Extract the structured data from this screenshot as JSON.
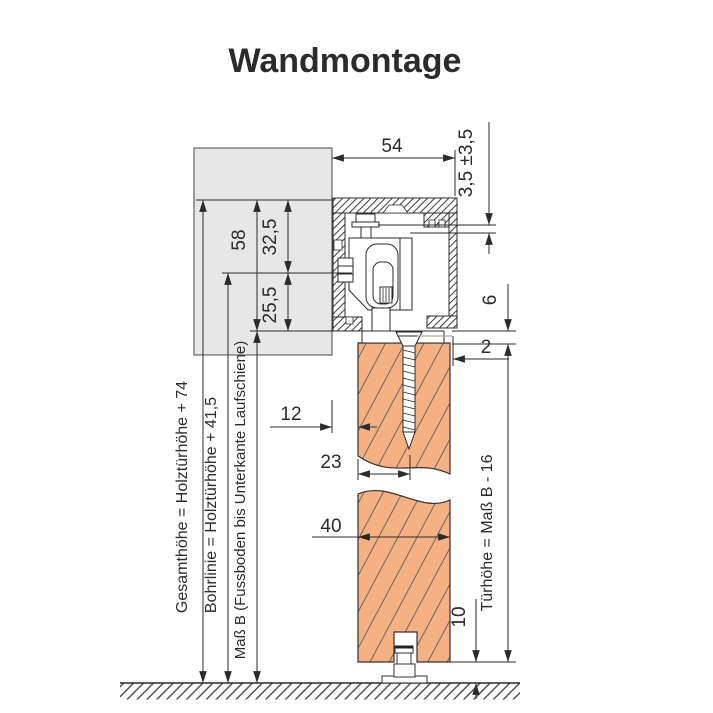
{
  "title": "Wandmontage",
  "colors": {
    "title": "#404040",
    "line": "#2b2b2b",
    "wall_fill": "#e8e7e7",
    "door_fill": "#f6b183",
    "door_hatch": "#666666",
    "aux_gray": "#a6a6a6"
  },
  "dimensions": {
    "track_width": "54",
    "height_adjust": "3,5 ±3,5",
    "rail_total_height": "58",
    "top_to_bolt_line": "32,5",
    "bolt_line_to_bottom": "25,5",
    "rail_to_door_gap": "6",
    "door_side_clearance": "2",
    "wall_to_door": "12",
    "door_edge_to_screw": "23",
    "door_thickness": "40",
    "floor_clearance": "10"
  },
  "labels": {
    "total_height": "Gesamthöhe = Holztürhöhe + 74",
    "drill_line": "Bohrlinie = Holztürhöhe + 41,5",
    "measure_b": "Maß B (Fussboden bis Unterkante Laufschiene)",
    "door_height": "Türhöhe = Maß B - 16"
  }
}
